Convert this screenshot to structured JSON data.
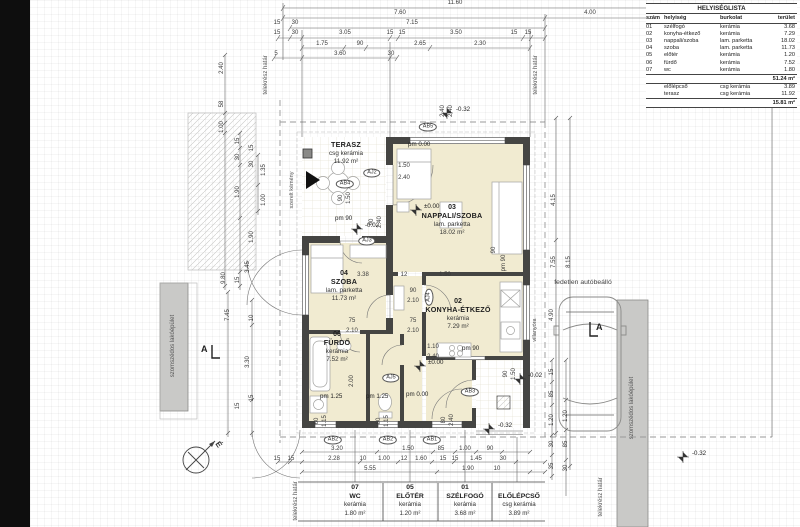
{
  "room_list": {
    "title": "HELYISÉGLISTA",
    "headers": [
      "szám",
      "helyiség",
      "burkolat",
      "terület"
    ],
    "rows": [
      [
        "01",
        "szélfogó",
        "kerámia",
        "3.68"
      ],
      [
        "02",
        "konyha-étkező",
        "kerámia",
        "7.29"
      ],
      [
        "03",
        "nappali/szoba",
        "lam. parketta",
        "18.02"
      ],
      [
        "04",
        "szoba",
        "lam. parketta",
        "11.73"
      ],
      [
        "05",
        "előtér",
        "kerámia",
        "1.20"
      ],
      [
        "06",
        "fürdő",
        "kerámia",
        "7.52"
      ],
      [
        "07",
        "wc",
        "kerámia",
        "1.80"
      ]
    ],
    "subtotal": "51.24 m²",
    "extra_rows": [
      [
        "",
        "előlépcső",
        "csg kerámia",
        "3.89"
      ],
      [
        "",
        "terasz",
        "csg kerámia",
        "11.92"
      ]
    ],
    "total": "15.81 m²"
  },
  "rooms": {
    "terasz": {
      "name": "TERASZ",
      "material": "csg kerámia",
      "area": "11.92 m²"
    },
    "nappali": {
      "num": "03",
      "name": "NAPPALI/SZOBA",
      "material": "lam. parketta",
      "area": "18.02 m²"
    },
    "szoba": {
      "num": "04",
      "name": "SZOBA",
      "material": "lam. parketta",
      "area": "11.73 m²"
    },
    "konyha": {
      "num": "02",
      "name": "KONYHA-ÉTKEZŐ",
      "material": "kerámia",
      "area": "7.29 m²"
    },
    "furdo": {
      "num": "06",
      "name": "FÜRDŐ",
      "material": "kerámia",
      "area": "7.52 m²"
    }
  },
  "bottom_labels": [
    {
      "num": "07",
      "name": "WC",
      "material": "kerámia",
      "area": "1.80 m²"
    },
    {
      "num": "05",
      "name": "ELŐTÉR",
      "material": "kerámia",
      "area": "1.20 m²"
    },
    {
      "num": "01",
      "name": "SZÉLFOGÓ",
      "material": "kerámia",
      "area": "3.68 m²"
    },
    {
      "num": "",
      "name": "ELŐLÉPCSŐ",
      "material": "csg kerámia",
      "area": "3.89 m²"
    }
  ],
  "site": {
    "neighbor": "szomszédos lakóépület",
    "carport": "fedetlen autóbeálló",
    "boundary": "telekrész határ",
    "electric_meter": "villanyóra",
    "chimney": "szerelt kémény",
    "north": "É",
    "section": "A"
  },
  "levels": {
    "zero": "±0.00",
    "minus02": "-0.02",
    "minus32": "-0.32",
    "pm0": "pm 0.00",
    "pm90": "pm 90",
    "pm125": "pm 1.25"
  },
  "tags": {
    "ab1": "AB1",
    "ab2": "AB2",
    "ab3": "AB3",
    "ab4": "AB4",
    "ab5": "AB5",
    "aj2": "AJ2",
    "aj3": "AJ3",
    "aj4": "AJ4",
    "aj5": "AJ5"
  },
  "dims": {
    "top": [
      "11.60",
      "7.60",
      "4.00",
      "7.15",
      "15",
      "30",
      "15",
      "30",
      "3.05",
      "15",
      "15",
      "3.50",
      "15",
      "15",
      "1.75",
      "90",
      "2.65",
      "2.30",
      "5",
      "3.60",
      "30"
    ],
    "left": [
      "2.40",
      "58",
      "1.00",
      "15",
      "30",
      "1.90",
      "15",
      "30",
      "1.90",
      "1.35",
      "1.00",
      "15",
      "3.45",
      "9.80",
      "7.45",
      "10",
      "3.30",
      "15",
      "15"
    ],
    "right": [
      "4.15",
      "7.55",
      "8.15",
      "4.90",
      "15",
      "85",
      "1.20",
      "30",
      "35",
      "1.20",
      "85",
      "30",
      "90",
      "pm 90",
      "90",
      "1.50"
    ],
    "bottom": [
      "3.20",
      "1.50",
      "85",
      "1.00",
      "90",
      "15",
      "15",
      "2.28",
      "10",
      "1.00",
      "12",
      "1.60",
      "15",
      "15",
      "1.45",
      "30",
      "5.55",
      "1.90",
      "10"
    ],
    "win": [
      "60",
      "1.15",
      "60",
      "1.15",
      "80",
      "2.40",
      "2.40",
      "2.40",
      "90",
      "2.40",
      "1.50",
      "2.40",
      "75",
      "2.10",
      "90",
      "2.10",
      "75",
      "2.10",
      "1.10",
      "2.40",
      "90",
      "1.50",
      "3.38",
      "12",
      "1.50",
      "2.00"
    ]
  }
}
